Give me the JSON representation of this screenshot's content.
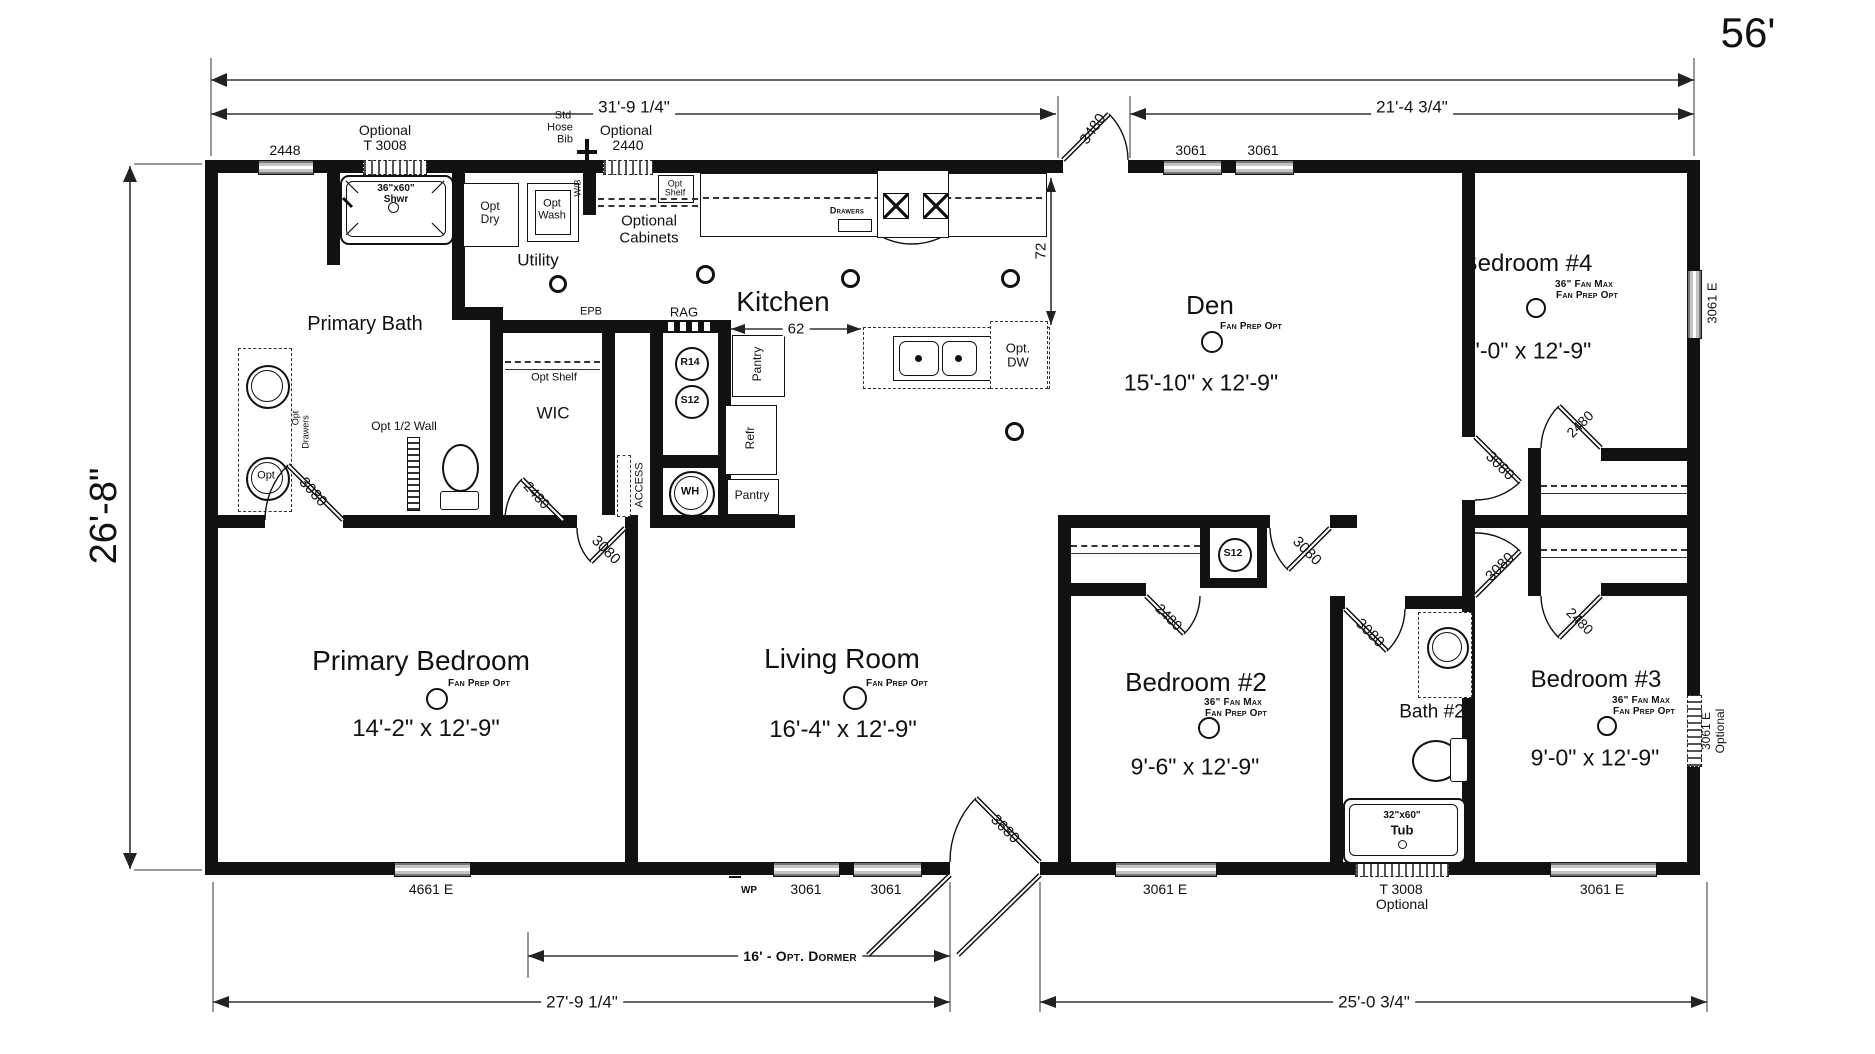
{
  "plan": {
    "overall": {
      "width_label": "56'",
      "depth_label": "26'-8\""
    },
    "dims": {
      "top_left": "31'-9 1/4\"",
      "top_right": "21'-4 3/4\"",
      "bottom_left": "27'-9 1/4\"",
      "bottom_right": "25'-0 3/4\"",
      "dormer": "16' - Opt. Dormer",
      "island_clearance": "62",
      "counter_to_island": "72"
    },
    "rooms": {
      "primary_bath": {
        "name": "Primary Bath"
      },
      "primary_bedroom": {
        "name": "Primary Bedroom",
        "fan": "Fan Prep Opt",
        "size": "14'-2\" x 12'-9\""
      },
      "living": {
        "name": "Living Room",
        "fan": "Fan Prep Opt",
        "size": "16'-4\" x 12'-9\""
      },
      "kitchen": {
        "name": "Kitchen"
      },
      "den": {
        "name": "Den",
        "fan": "Fan Prep Opt",
        "size": "15'-10\" x 12'-9\""
      },
      "bedroom2": {
        "name": "Bedroom #2",
        "fan1": "36\" Fan Max",
        "fan2": "Fan Prep Opt",
        "size": "9'-6\" x 12'-9\""
      },
      "bedroom3": {
        "name": "Bedroom #3",
        "fan1": "36\" Fan Max",
        "fan2": "Fan Prep Opt",
        "size": "9'-0\" x 12'-9\""
      },
      "bedroom4": {
        "name": "Bedroom #4",
        "fan1": "36\" Fan Max",
        "fan2": "Fan Prep Opt",
        "size": "9'-0\" x 12'-9\""
      },
      "bath2": {
        "name": "Bath #2"
      },
      "utility": {
        "name": "Utility"
      },
      "wic": {
        "name": "WIC"
      }
    },
    "windows": {
      "w2448": "2448",
      "t3008_line1": "Optional",
      "t3008_line2": "T 3008",
      "w2440_line1": "Optional",
      "w2440_line2": "2440",
      "den1": "3061",
      "den2": "3061",
      "b4_right": "3061 E",
      "b3_right1": "3061 E",
      "b3_right2": "Optional",
      "pb_bottom": "4661 E",
      "lr1": "3061",
      "lr2": "3061",
      "b2_bottom": "3061 E",
      "tub_line1": "T 3008",
      "tub_line2": "Optional",
      "b3_bottom": "3061 E"
    },
    "doors": {
      "entry_top": "3480",
      "entry_bottom": "3680",
      "pbath": "3080",
      "pbed": "3080",
      "wic": "2480",
      "den_hall": "3080",
      "bath2": "3080",
      "b2": "2480",
      "b4": "3080",
      "b3": "3080",
      "b4_closet": "2480",
      "b3_closet": "2480"
    },
    "fixtures": {
      "shower_line1": "36\"x60\"",
      "shower_line2": "Shwr",
      "tub_line1": "32\"x60\"",
      "tub_line2": "Tub",
      "dry1": "Opt",
      "dry2": "Dry",
      "wash1": "Opt",
      "wash2": "Wash",
      "hose1": "Std",
      "hose2": "Hose",
      "hose3": "Bib",
      "shelf1": "Opt",
      "shelf2": "Shelf",
      "optcab1": "Optional",
      "optcab2": "Cabinets",
      "wic_shelf": "Opt Shelf",
      "half_wall": "Opt 1/2 Wall",
      "vanity1": "Opt",
      "vanity2": "Drawers",
      "sink_opt": "Opt",
      "drawers": "Drawers",
      "dw1": "Opt.",
      "dw2": "DW",
      "pantry_u": "Pantry",
      "refr": "Refr",
      "pantry_l": "Pantry",
      "rag": "RAG",
      "r14": "R14",
      "s12": "S12",
      "s12b": "S12",
      "wh": "WH",
      "access": "ACCESS",
      "epb": "EPB",
      "wb": "W/B",
      "wp": "WP"
    }
  }
}
